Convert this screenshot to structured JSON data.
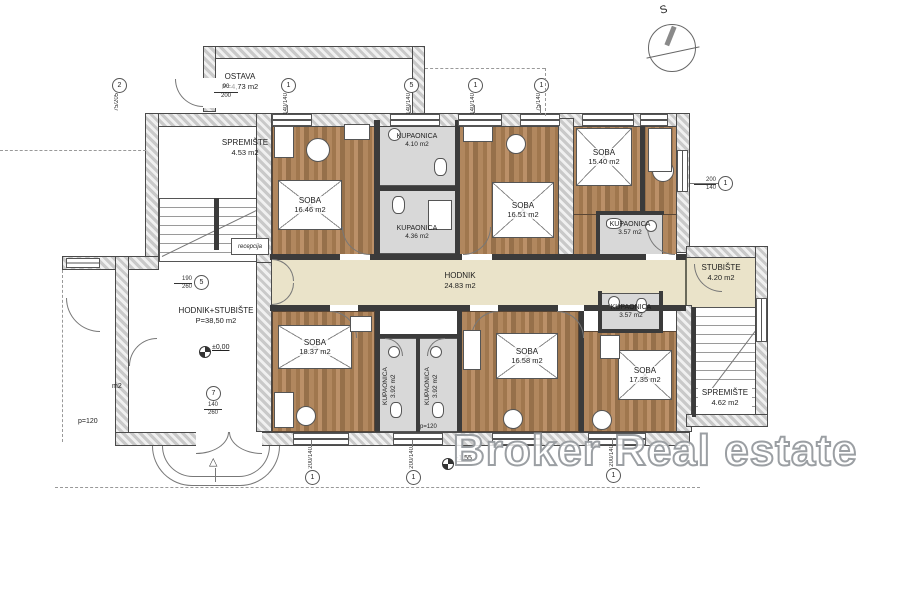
{
  "meta": {
    "north_label": "S",
    "watermark": "Broker Real estate",
    "plan_type": "floor-plan"
  },
  "colors": {
    "wood_floor": "#a9805a",
    "corridor_floor": "#eae3c9",
    "bathroom_floor": "#d8d8d8",
    "wall_hatch": "#c9c9c9"
  },
  "rooms": {
    "ostava": {
      "name": "OSTAVA",
      "area": "P=4,73 m2"
    },
    "spremiste_l": {
      "name": "SPREMIŠTE",
      "area": "4.53 m2"
    },
    "recepcija": {
      "name": "recepcija"
    },
    "hodnik_stubiste": {
      "name": "HODNIK+STUBIŠTE",
      "area": "P=38,50 m2"
    },
    "hodnik": {
      "name": "HODNIK",
      "area": "24.83 m2"
    },
    "stubiste": {
      "name": "STUBIŠTE",
      "area": "4.20 m2"
    },
    "spremiste_r": {
      "name": "SPREMIŠTE",
      "area": "4.62 m2"
    },
    "soba1": {
      "name": "SOBA",
      "area": "16.46 m2"
    },
    "soba2": {
      "name": "SOBA",
      "area": "16.51 m2"
    },
    "soba3": {
      "name": "SOBA",
      "area": "15.40 m2"
    },
    "soba4": {
      "name": "SOBA",
      "area": "18.37 m2"
    },
    "soba5": {
      "name": "SOBA",
      "area": "16.58 m2"
    },
    "soba6": {
      "name": "SOBA",
      "area": "17.35 m2"
    },
    "kup1": {
      "name": "KUPAONICA",
      "area": "4.10 m2"
    },
    "kup2": {
      "name": "KUPAONICA",
      "area": "4.36 m2"
    },
    "kup3": {
      "name": "KUPAONICA",
      "area": "3.57 m2"
    },
    "kup4": {
      "name": "KUPAONICA",
      "area": "3.92 m2"
    },
    "kup5": {
      "name": "KUPAONICA",
      "area": "3.92 m2"
    },
    "kup6": {
      "name": "KUPAONICA",
      "area": "3.57 m2"
    }
  },
  "door_ostava": {
    "w": "90",
    "h": "200"
  },
  "marks": [
    {
      "num": "2",
      "dim": "75/205",
      "w": "75",
      "h": "205"
    },
    {
      "num": "1",
      "dim": "140/140",
      "w": "140",
      "h": "140"
    },
    {
      "num": "5",
      "dim": "140/140",
      "w": "140",
      "h": "140"
    },
    {
      "num": "1",
      "dim": "140/140",
      "w": "140",
      "h": "140"
    },
    {
      "num": "1",
      "dim": "75/140",
      "w": "75",
      "h": "140"
    },
    {
      "num": "1",
      "dim": "200/140",
      "w": "200",
      "h": "140"
    },
    {
      "num": "5",
      "dim": "190/260",
      "w": "190",
      "h": "260"
    },
    {
      "num": "7",
      "dim": "140/260",
      "w": "140",
      "h": "260"
    },
    {
      "num": "1",
      "dim": "200/140",
      "w": "200",
      "h": "140"
    },
    {
      "num": "1",
      "dim": "200/140",
      "w": "200",
      "h": "140"
    },
    {
      "num": "1",
      "dim": "200/140",
      "w": "200",
      "h": "140"
    }
  ],
  "levels": {
    "zero": "±0,00",
    "minus": "-1,55"
  },
  "notes": {
    "parapet": "p=120",
    "fragment": "m2"
  }
}
